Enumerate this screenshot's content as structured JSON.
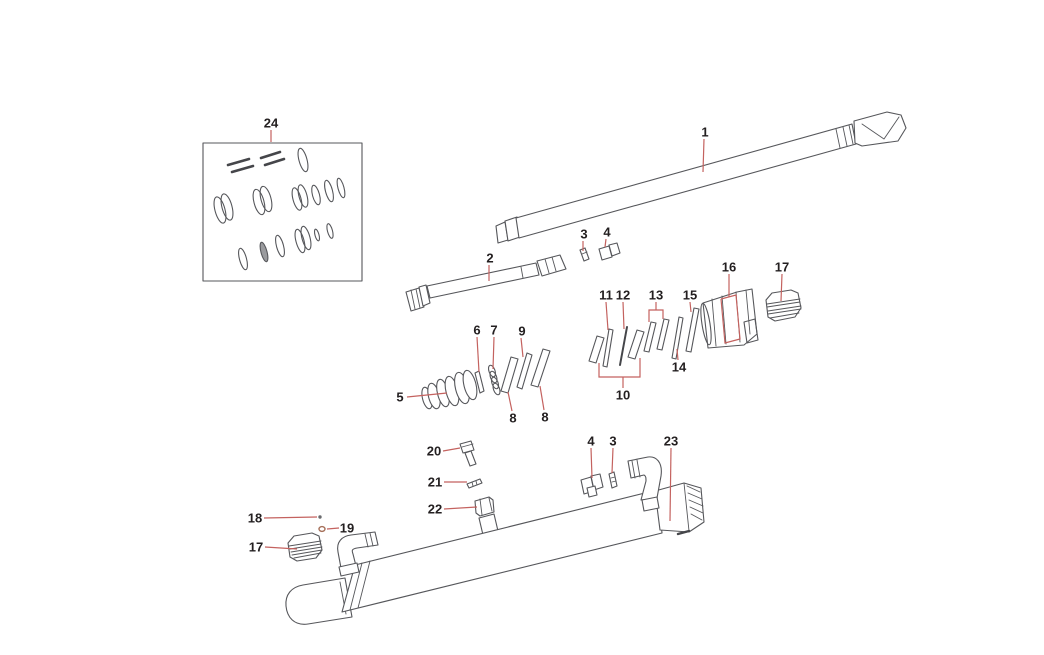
{
  "page": {
    "background_color": "#ffffff"
  },
  "diagram": {
    "description": "Exploded parts diagram of a hydraulic cylinder assembly with numbered callouts",
    "colors": {
      "part_outline": "#56575b",
      "leader_line": "#c4625f",
      "label_text": "#231f20"
    },
    "label_font_size_px": 13,
    "callouts": [
      {
        "part": "24",
        "x": 271,
        "y": 123,
        "leaders": [
          [
            [
              271,
              130
            ],
            [
              271,
              142
            ]
          ]
        ]
      },
      {
        "part": "1",
        "x": 705,
        "y": 132,
        "leaders": [
          [
            [
              704,
              139
            ],
            [
              703,
              172
            ]
          ]
        ]
      },
      {
        "part": "2",
        "x": 490,
        "y": 258,
        "leaders": [
          [
            [
              489,
              265
            ],
            [
              489,
              281
            ]
          ]
        ]
      },
      {
        "part": "3",
        "x": 584,
        "y": 234,
        "leaders": [
          [
            [
              583,
              241
            ],
            [
              583,
              251
            ]
          ]
        ]
      },
      {
        "part": "4",
        "x": 607,
        "y": 232,
        "leaders": [
          [
            [
              606,
              239
            ],
            [
              605,
              247
            ]
          ]
        ]
      },
      {
        "part": "5",
        "x": 400,
        "y": 397,
        "leaders": [
          [
            [
              407,
              397
            ],
            [
              447,
              393
            ]
          ]
        ]
      },
      {
        "part": "6",
        "x": 477,
        "y": 330,
        "leaders": [
          [
            [
              477,
              337
            ],
            [
              479,
              372
            ]
          ]
        ]
      },
      {
        "part": "7",
        "x": 494,
        "y": 330,
        "leaders": [
          [
            [
              494,
              337
            ],
            [
              493,
              369
            ]
          ]
        ]
      },
      {
        "part": "9",
        "x": 522,
        "y": 331,
        "leaders": [
          [
            [
              521,
              338
            ],
            [
              523,
              357
            ]
          ]
        ]
      },
      {
        "part": "8",
        "x": 513,
        "y": 418,
        "leaders": [
          [
            [
              512,
              411
            ],
            [
              508,
              392
            ]
          ]
        ]
      },
      {
        "part": "8",
        "x": 545,
        "y": 417,
        "leaders": [
          [
            [
              544,
              410
            ],
            [
              540,
              386
            ]
          ]
        ]
      },
      {
        "part": "11",
        "x": 606,
        "y": 295,
        "leaders": [
          [
            [
              606,
              302
            ],
            [
              608,
              330
            ]
          ]
        ]
      },
      {
        "part": "12",
        "x": 623,
        "y": 295,
        "leaders": [
          [
            [
              623,
              302
            ],
            [
              624,
              329
            ]
          ]
        ]
      },
      {
        "part": "13",
        "x": 656,
        "y": 295,
        "leaders": [
          [
            [
              656,
              302
            ],
            [
              656,
              310
            ]
          ],
          [
            [
              649,
              322
            ],
            [
              649,
              310
            ],
            [
              663,
              310
            ],
            [
              663,
              319
            ]
          ]
        ]
      },
      {
        "part": "15",
        "x": 690,
        "y": 295,
        "leaders": [
          [
            [
              690,
              302
            ],
            [
              691,
              312
            ]
          ]
        ]
      },
      {
        "part": "14",
        "x": 679,
        "y": 367,
        "leaders": [
          [
            [
              678,
              360
            ],
            [
              677,
              349
            ]
          ]
        ]
      },
      {
        "part": "10",
        "x": 623,
        "y": 395,
        "leaders": [
          [
            [
              623,
              388
            ],
            [
              623,
              377
            ]
          ],
          [
            [
              599,
              363
            ],
            [
              599,
              377
            ],
            [
              640,
              377
            ],
            [
              640,
              358
            ]
          ]
        ]
      },
      {
        "part": "16",
        "x": 729,
        "y": 267,
        "leaders": [
          [
            [
              729,
              274
            ],
            [
              729,
              297
            ]
          ],
          [
            [
              721,
              299
            ],
            [
              736,
              295
            ],
            [
              740,
              339
            ],
            [
              725,
              343
            ],
            [
              721,
              299
            ]
          ]
        ]
      },
      {
        "part": "17",
        "x": 782,
        "y": 267,
        "leaders": [
          [
            [
              782,
              274
            ],
            [
              781,
              301
            ]
          ]
        ]
      },
      {
        "part": "20",
        "x": 434,
        "y": 451,
        "leaders": [
          [
            [
              443,
              451
            ],
            [
              460,
              448
            ]
          ]
        ]
      },
      {
        "part": "21",
        "x": 435,
        "y": 482,
        "leaders": [
          [
            [
              444,
              482
            ],
            [
              467,
              482
            ]
          ]
        ]
      },
      {
        "part": "22",
        "x": 435,
        "y": 509,
        "leaders": [
          [
            [
              444,
              509
            ],
            [
              477,
              507
            ]
          ]
        ]
      },
      {
        "part": "4",
        "x": 591,
        "y": 441,
        "leaders": [
          [
            [
              591,
              448
            ],
            [
              592,
              478
            ]
          ]
        ]
      },
      {
        "part": "3",
        "x": 613,
        "y": 441,
        "leaders": [
          [
            [
              613,
              448
            ],
            [
              612,
              473
            ]
          ]
        ]
      },
      {
        "part": "23",
        "x": 671,
        "y": 441,
        "leaders": [
          [
            [
              671,
              448
            ],
            [
              670,
              521
            ]
          ]
        ]
      },
      {
        "part": "18",
        "x": 255,
        "y": 518,
        "leaders": [
          [
            [
              264,
              518
            ],
            [
              317,
              517
            ]
          ]
        ]
      },
      {
        "part": "19",
        "x": 347,
        "y": 528,
        "leaders": [
          [
            [
              339,
              528
            ],
            [
              327,
              529
            ]
          ]
        ]
      },
      {
        "part": "17",
        "x": 256,
        "y": 547,
        "leaders": [
          [
            [
              265,
              547
            ],
            [
              297,
              549
            ]
          ]
        ]
      }
    ]
  }
}
